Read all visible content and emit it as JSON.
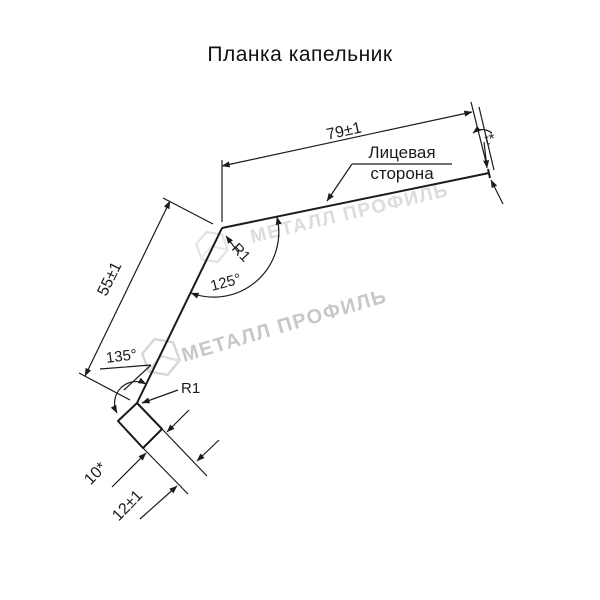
{
  "title": "Планка капельник",
  "drawing": {
    "dim_width": "79±1",
    "dim_height": "55±1",
    "dim_hem": "12±1",
    "dim_hem_fold": "10*",
    "thickness": "t*",
    "angle_top": "125°",
    "angle_bottom": "135°",
    "radius_top": "R1",
    "radius_bottom": "R1",
    "face_label_line1": "Лицевая",
    "face_label_line2": "сторона"
  },
  "watermark": {
    "text": "МЕТАЛЛ ПРОФИЛЬ"
  },
  "colors": {
    "line": "#1b1b1b",
    "watermark": "#c7c7c7",
    "background": "#ffffff"
  }
}
